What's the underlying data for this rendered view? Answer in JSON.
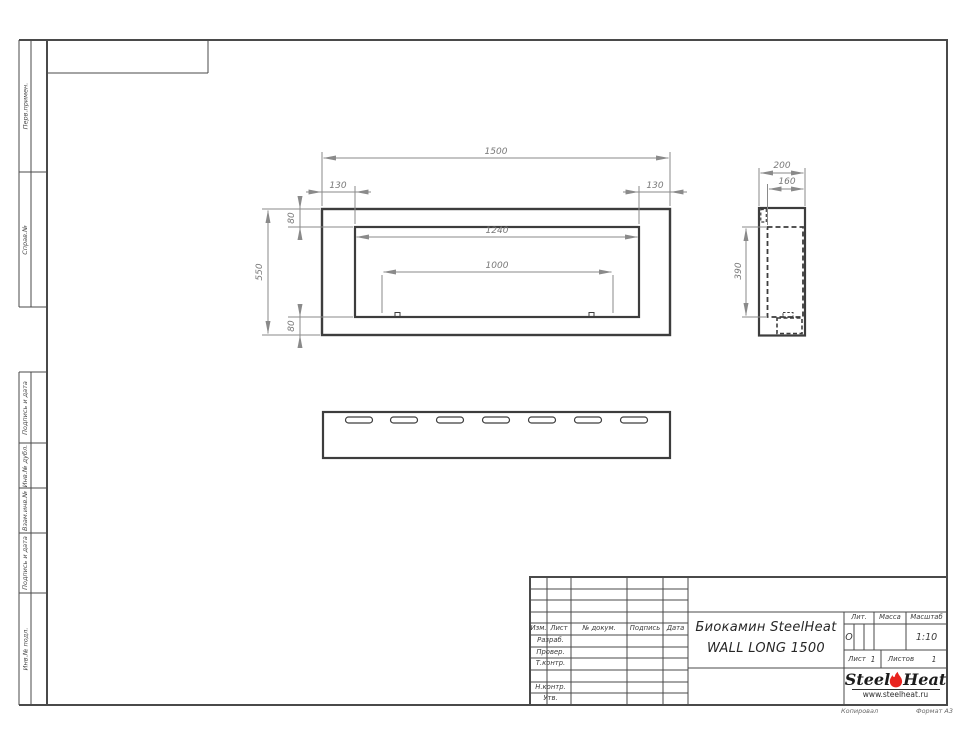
{
  "drawing_title": {
    "line1": "Биокамин SteelHeat",
    "line2": "WALL LONG 1500"
  },
  "views": {
    "front": {
      "width": "1500",
      "height": "550",
      "left_offset": "130",
      "right_offset": "130",
      "top_offset": "80",
      "bottom_offset": "80",
      "opening_width": "1240",
      "burner_width": "1000"
    },
    "side": {
      "depth": "200",
      "inner_depth": "160",
      "inner_height": "390"
    }
  },
  "margin_labels": [
    "Перв.примен.",
    "Справ.№",
    "Подпись и дата",
    "Инв.№ дубл.",
    "Взам.инв.№",
    "Подпись и дата",
    "Инв.№ подл."
  ],
  "title_block": {
    "columns": {
      "izm": "Изм.",
      "list": "Лист",
      "doc": "№ докум.",
      "sign": "Подпись",
      "date": "Дата"
    },
    "rows": {
      "developed": "Разраб.",
      "checked": "Провер.",
      "tcontrol": "Т.контр.",
      "ncontrol": "Н.контр.",
      "approved": "Утв."
    },
    "lit_label": "Лит.",
    "lit_value": "О",
    "mass_label": "Масса",
    "scale_label": "Масштаб",
    "scale_value": "1:10",
    "sheet_label": "Лист",
    "sheet_value": "1",
    "sheets_label": "Листов",
    "sheets_value": "1"
  },
  "logo": {
    "word1": "Steel",
    "word2": "Heat",
    "url": "www.steelheat.ru"
  },
  "footer": {
    "copied": "Копировал",
    "format": "Формат А3"
  },
  "colors": {
    "line_dark": "#3d3d3d",
    "line_dim": "#8a8a8a",
    "flame_red": "#e8231f"
  }
}
